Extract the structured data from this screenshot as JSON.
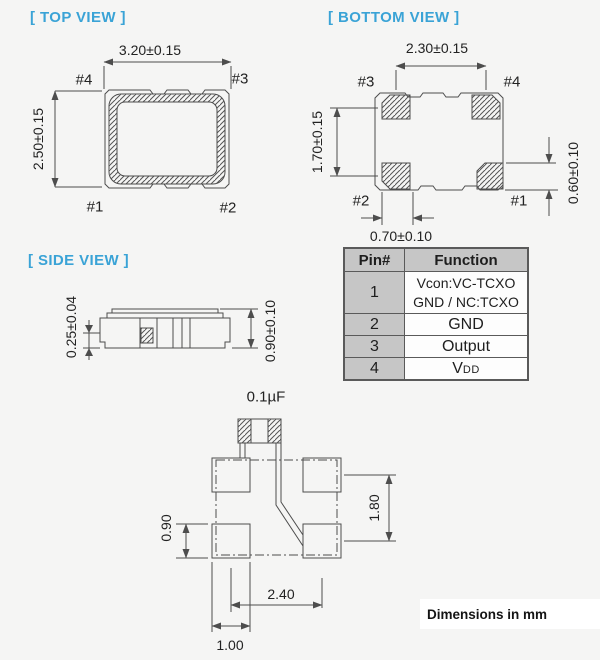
{
  "colors": {
    "accent": "#3aa3d6",
    "line": "#4d4d4d",
    "table_header_gray": "#c6c6c6",
    "background": "#f5f5f4"
  },
  "top_view": {
    "title": "[ TOP VIEW ]",
    "width_dim": "3.20±0.15",
    "height_dim": "2.50±0.15",
    "pin_top_left": "#4",
    "pin_top_right": "#3",
    "pin_bottom_left": "#1",
    "pin_bottom_right": "#2"
  },
  "bottom_view": {
    "title": "[ BOTTOM VIEW ]",
    "width_dim": "2.30±0.15",
    "height_dim": "1.70±0.15",
    "pad_height_dim": "0.60±0.10",
    "pad_width_dim": "0.70±0.10",
    "pin_top_left": "#3",
    "pin_top_right": "#4",
    "pin_bottom_left": "#2",
    "pin_bottom_right": "#1"
  },
  "side_view": {
    "title": "[ SIDE VIEW ]",
    "terminal_dim": "0.25±0.04",
    "height_dim": "0.90±0.10"
  },
  "land_pattern": {
    "capacitor_label": "0.1µF",
    "vertical_pitch_dim": "1.80",
    "pad_height_dim": "0.90",
    "horizontal_pitch_dim": "2.40",
    "pad_width_dim": "1.00"
  },
  "pin_table": {
    "headers": [
      "Pin#",
      "Function"
    ],
    "rows": [
      {
        "pin": "1",
        "function_line1": "Vcon:VC-TCXO",
        "function_line2": "GND / NC:TCXO"
      },
      {
        "pin": "2",
        "function": "GND"
      },
      {
        "pin": "3",
        "function": "Output"
      },
      {
        "pin": "4",
        "function_main": "V",
        "function_sub": "DD"
      }
    ]
  },
  "footer": {
    "note": "Dimensions in mm"
  }
}
